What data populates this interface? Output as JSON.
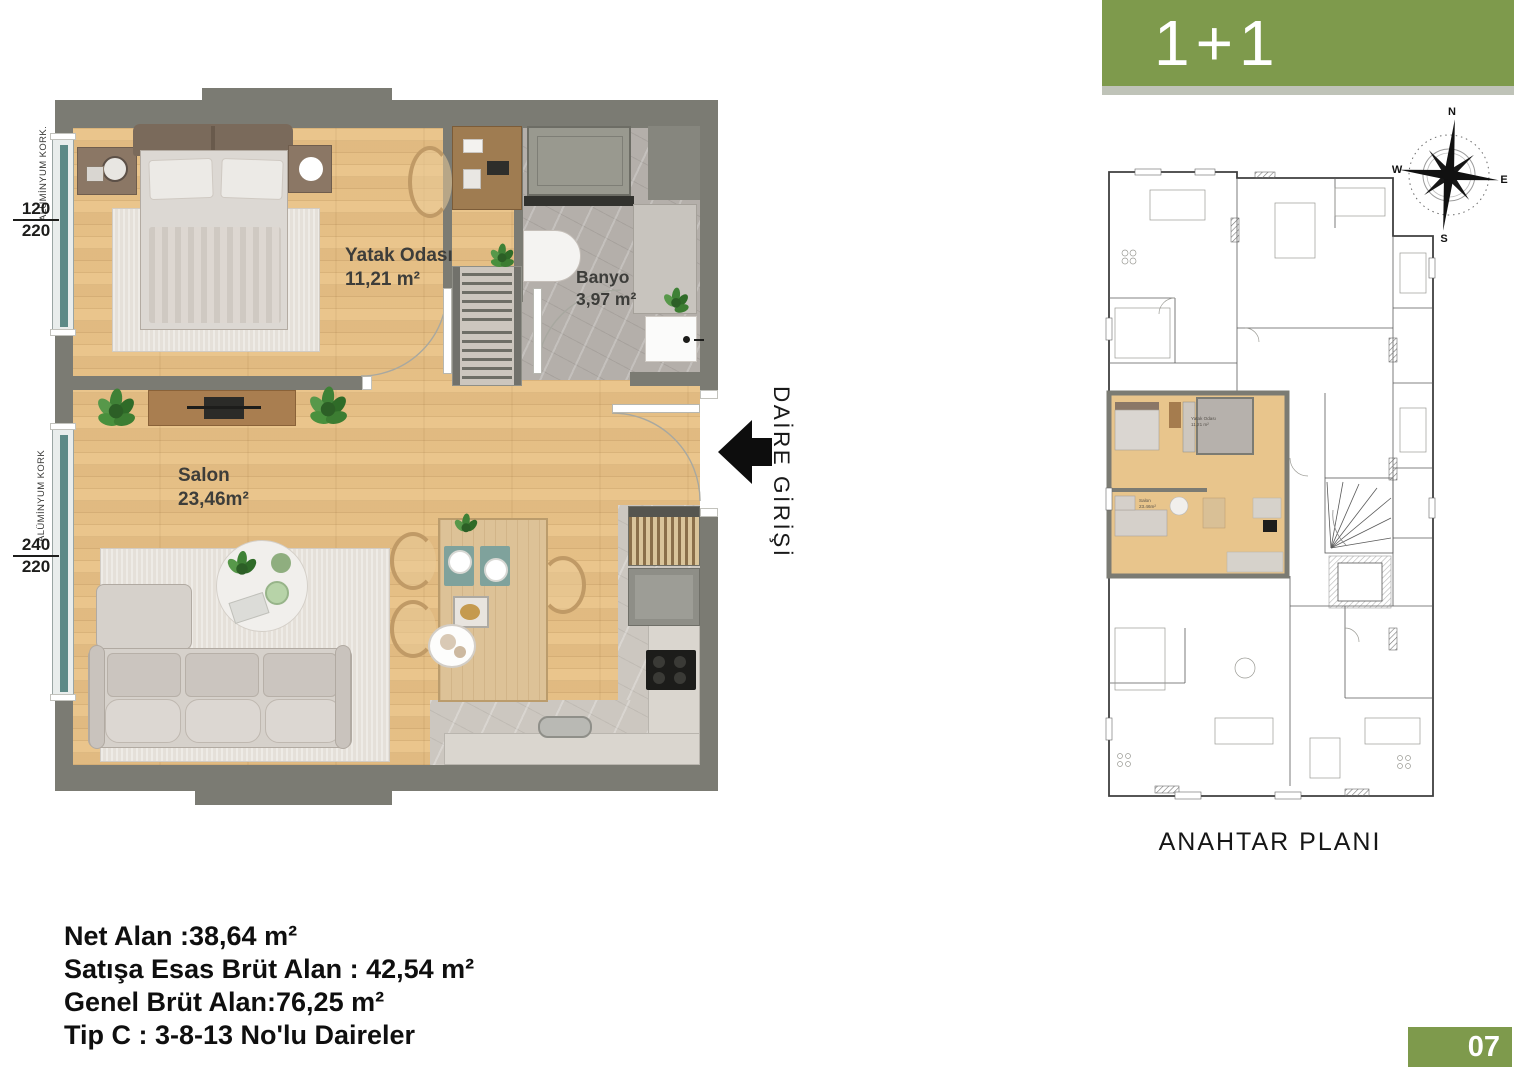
{
  "colors": {
    "accent_green": "#7e9a4c",
    "wall_gray": "#7b7b73",
    "wood": "#ebc78e"
  },
  "banner": {
    "label": "1+1"
  },
  "main_plan": {
    "rooms": [
      {
        "name": "Yatak Odası",
        "area": "11,21 m²"
      },
      {
        "name": "Banyo",
        "area": "3,97 m²"
      },
      {
        "name": "Salon",
        "area": "23,46m²"
      }
    ],
    "entrance_label": "DAİRE GİRİŞİ",
    "windows": [
      {
        "material": "ALÜMİNYUM KORK.",
        "width_cm": "120",
        "height_cm": "220"
      },
      {
        "material": "ALÜMİNYUM KORK",
        "width_cm": "240",
        "height_cm": "220"
      }
    ]
  },
  "key_plan": {
    "title": "ANAHTAR PLANI",
    "compass": {
      "n": "N",
      "e": "E",
      "s": "S",
      "w": "W"
    },
    "mini_labels": [
      {
        "name": "Yatak Odası",
        "area": "11,21 m²"
      },
      {
        "name": "Salon",
        "area": "23.46m²"
      }
    ]
  },
  "info": {
    "net_alan": "Net Alan :38,64 m²",
    "satis_brut": "Satışa Esas Brüt Alan : 42,54 m²",
    "genel_brut": "Genel Brüt Alan:76,25 m²",
    "tip": "Tip C : 3-8-13 No'lu Daireler"
  },
  "page": {
    "number": "07"
  }
}
